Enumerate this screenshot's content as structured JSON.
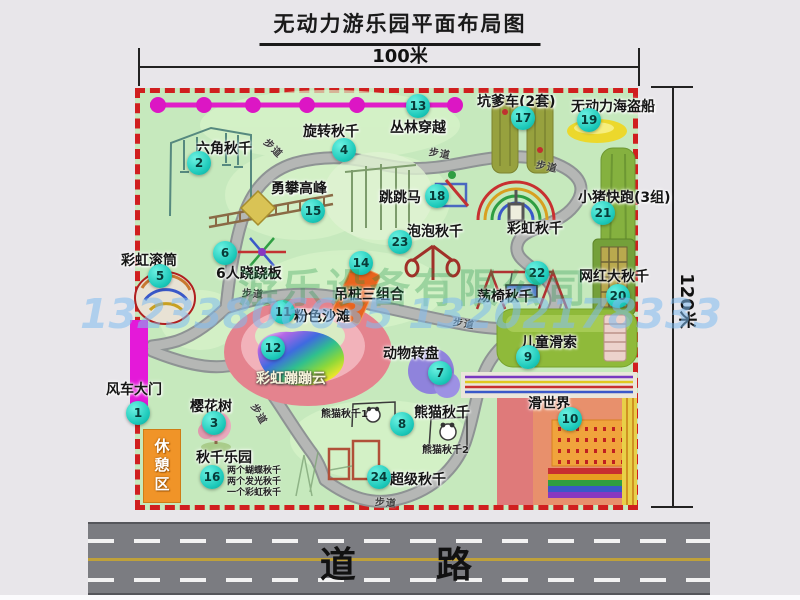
{
  "title": "无动力游乐园平面布局图",
  "dimensions": {
    "top": "100米",
    "right": "120米"
  },
  "road": {
    "label": "道    路"
  },
  "watermarks": {
    "company": "游乐设备有限公司",
    "phone": "13233806635 13202178333"
  },
  "rest_area": "休憩区",
  "footpath_text": "步道",
  "swing_park_notes": "两个蝴蝶秋千\n两个发光秋千\n一个彩虹秋千",
  "colors": {
    "park_green": "#c6e9bd",
    "border_red": "#d01f1f",
    "badge_teal": "#1cc9ba",
    "chain_magenta": "#dc16c4",
    "gate_magenta": "#e419d9",
    "rest_orange": "#f09428",
    "road_gray": "#7b7c81",
    "lane_yellow": "#bfa13a"
  },
  "attractions": [
    {
      "num": "1",
      "name": "风车大门",
      "lx": 106,
      "ly": 379,
      "nx": 138,
      "ny": 413
    },
    {
      "num": "2",
      "name": "六角秋千",
      "lx": 196,
      "ly": 138,
      "nx": 199,
      "ny": 163
    },
    {
      "num": "3",
      "name": "樱花树",
      "lx": 190,
      "ly": 396,
      "nx": 214,
      "ny": 423
    },
    {
      "num": "4",
      "name": "旋转秋千",
      "lx": 303,
      "ly": 121,
      "nx": 344,
      "ny": 150
    },
    {
      "num": "5",
      "name": "彩虹滚筒",
      "lx": 121,
      "ly": 250,
      "nx": 160,
      "ny": 276
    },
    {
      "num": "6",
      "name": "6人跷跷板",
      "lx": 216,
      "ly": 263,
      "nx": 225,
      "ny": 253
    },
    {
      "num": "7",
      "name": "动物转盘",
      "lx": 383,
      "ly": 343,
      "nx": 440,
      "ny": 373
    },
    {
      "num": "8",
      "name": "熊猫秋千",
      "lx": 414,
      "ly": 402,
      "nx": 402,
      "ny": 424
    },
    {
      "num": "9",
      "name": "儿童滑索",
      "lx": 521,
      "ly": 332,
      "nx": 528,
      "ny": 357
    },
    {
      "num": "10",
      "name": "滑世界",
      "lx": 528,
      "ly": 393,
      "nx": 570,
      "ny": 419
    },
    {
      "num": "11",
      "name": "粉色沙滩",
      "lx": 294,
      "ly": 306,
      "nx": 283,
      "ny": 312
    },
    {
      "num": "12",
      "name": "彩虹蹦蹦云",
      "lx": 256,
      "ly": 368,
      "nx": 273,
      "ny": 348,
      "light": true
    },
    {
      "num": "13",
      "name": "丛林穿越",
      "lx": 390,
      "ly": 117,
      "nx": 418,
      "ny": 106
    },
    {
      "num": "14",
      "name": "吊桩三组合",
      "lx": 334,
      "ly": 284,
      "nx": 361,
      "ny": 263
    },
    {
      "num": "15",
      "name": "勇攀高峰",
      "lx": 271,
      "ly": 178,
      "nx": 313,
      "ny": 211
    },
    {
      "num": "16",
      "name": "秋千乐园",
      "lx": 196,
      "ly": 447,
      "nx": 212,
      "ny": 477
    },
    {
      "num": "17",
      "name": "坑爹车(2套)",
      "lx": 477,
      "ly": 91,
      "nx": 523,
      "ny": 118
    },
    {
      "num": "18",
      "name": "跳跳马",
      "lx": 379,
      "ly": 187,
      "nx": 437,
      "ny": 196
    },
    {
      "num": "19",
      "name": "无动力海盗船",
      "lx": 571,
      "ly": 96,
      "nx": 589,
      "ny": 120
    },
    {
      "num": "20",
      "name": "网红大秋千",
      "lx": 579,
      "ly": 266,
      "nx": 618,
      "ny": 296
    },
    {
      "num": "21",
      "name": "小猪快跑(3组)",
      "lx": 578,
      "ly": 187,
      "nx": 603,
      "ny": 213
    },
    {
      "num": "22",
      "name": "荡椅秋千",
      "lx": 477,
      "ly": 286,
      "nx": 537,
      "ny": 273
    },
    {
      "num": "23",
      "name": "泡泡秋千",
      "lx": 407,
      "ly": 221,
      "nx": 400,
      "ny": 242
    },
    {
      "num": "24",
      "name": "超级秋千",
      "lx": 390,
      "ly": 469,
      "nx": 379,
      "ny": 477
    },
    {
      "num": "",
      "name": "彩虹秋千",
      "lx": 507,
      "ly": 218,
      "nx": 0,
      "ny": 0
    }
  ],
  "small_labels": [
    {
      "text": "熊猫秋千1",
      "x": 321,
      "y": 405
    },
    {
      "text": "熊猫秋千2",
      "x": 422,
      "y": 441
    }
  ],
  "path_labels": [
    {
      "x": 263,
      "y": 140,
      "r": 45
    },
    {
      "x": 429,
      "y": 145,
      "r": 10
    },
    {
      "x": 536,
      "y": 158,
      "r": 12
    },
    {
      "x": 242,
      "y": 285,
      "r": 5
    },
    {
      "x": 453,
      "y": 315,
      "r": 10
    },
    {
      "x": 249,
      "y": 406,
      "r": 60
    },
    {
      "x": 375,
      "y": 494,
      "r": 5
    }
  ]
}
